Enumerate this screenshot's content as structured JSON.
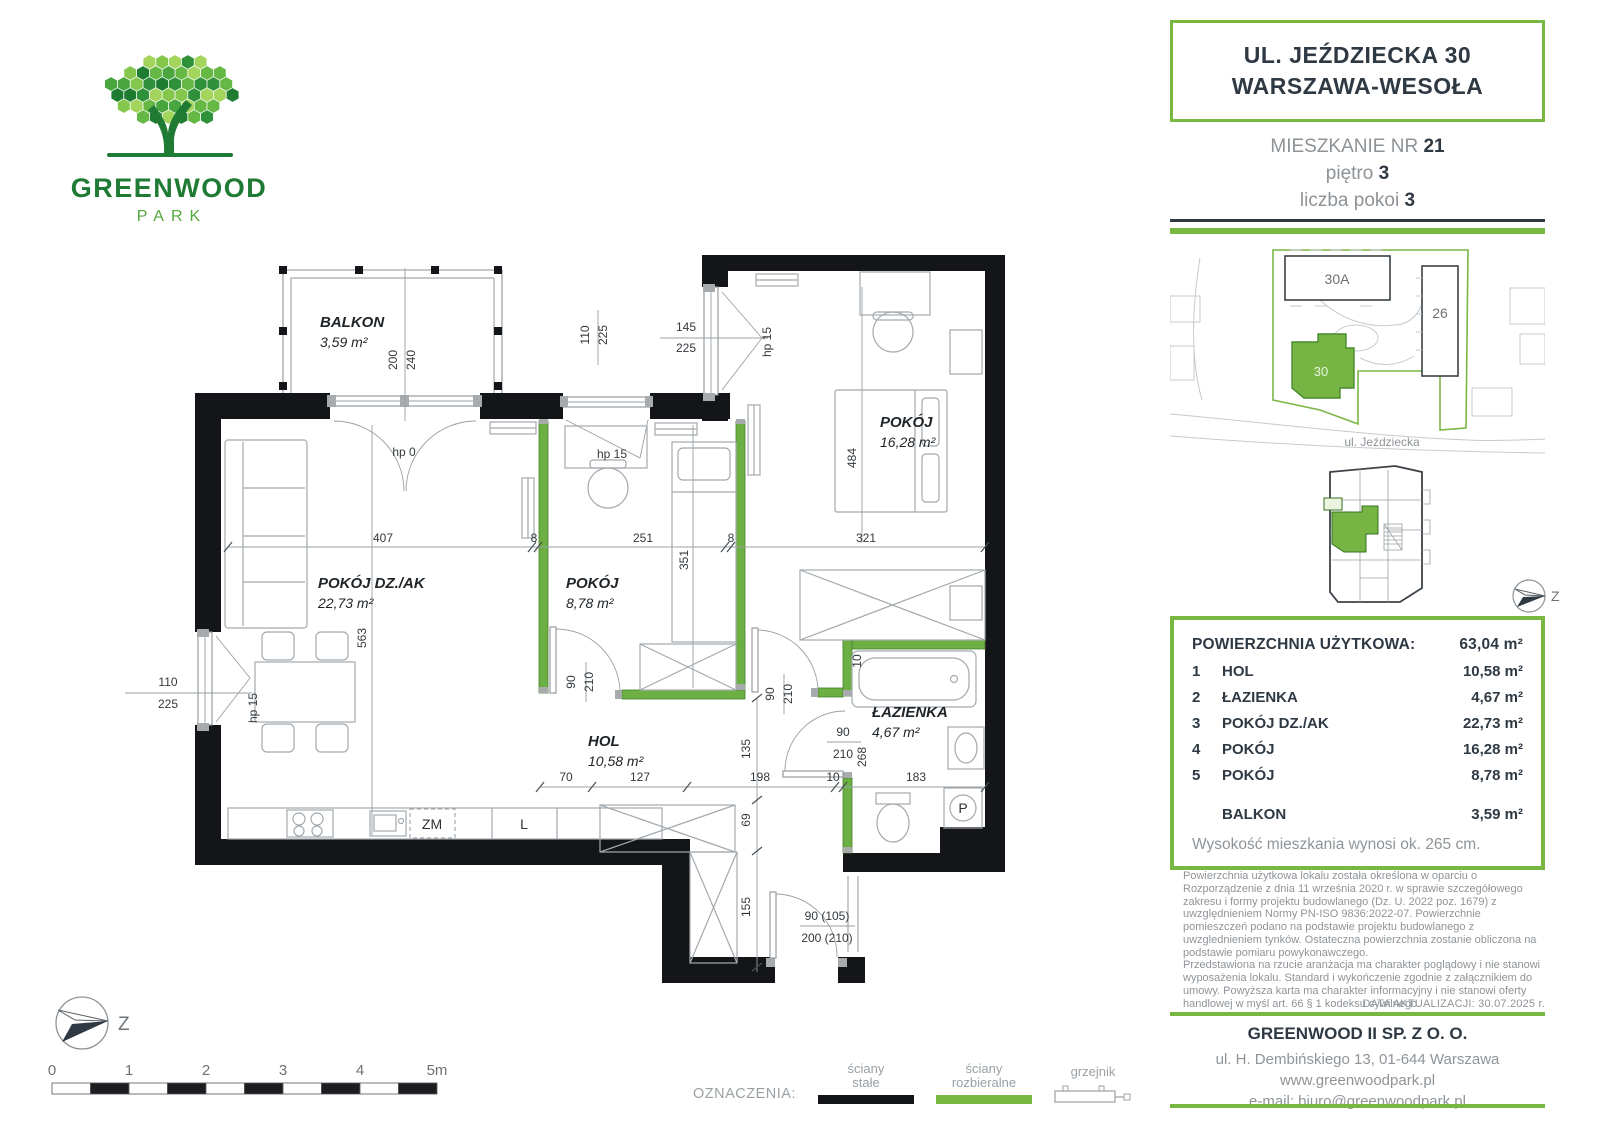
{
  "logo": {
    "title": "GREENWOOD",
    "subtitle": "PARK"
  },
  "header": {
    "address_line1": "UL. JEŹDZIECKA 30",
    "address_line2": "WARSZAWA-WESOŁA",
    "unit_label": "MIESZKANIE NR",
    "unit_number": "21",
    "floor_label": "piętro",
    "floor_value": "3",
    "rooms_label": "liczba pokoi",
    "rooms_value": "3"
  },
  "site_plan": {
    "building_a": "30A",
    "building_b": "26",
    "building_current": "30",
    "street": "ul. Jeździecka"
  },
  "compass": {
    "label": "Z"
  },
  "areas_panel": {
    "title": "POWIERZCHNIA UŻYTKOWA:",
    "total": "63,04 m²",
    "rows": [
      {
        "no": "1",
        "name": "HOL",
        "area": "10,58 m²"
      },
      {
        "no": "2",
        "name": "ŁAZIENKA",
        "area": "4,67 m²"
      },
      {
        "no": "3",
        "name": "POKÓJ DZ./AK",
        "area": "22,73 m²"
      },
      {
        "no": "4",
        "name": "POKÓJ",
        "area": "16,28 m²"
      },
      {
        "no": "5",
        "name": "POKÓJ",
        "area": "8,78 m²"
      }
    ],
    "balcony_row": {
      "no": "",
      "name": "BALKON",
      "area": "3,59 m²"
    },
    "height_note": "Wysokość mieszkania wynosi ok. 265 cm."
  },
  "disclaimer": {
    "p1": "Powierzchnia użytkowa lokalu została określona w oparciu o Rozporządzenie z dnia 11 września 2020 r. w sprawie szczegółowego zakresu i formy projektu budowlanego (Dz. U. 2022 poz. 1679) z uwzględnieniem Normy PN-ISO 9836:2022-07. Powierzchnie pomieszczeń podano na podstawie projektu budowlanego z uwzglednieniem tynków. Ostateczna powierzchnia zostanie obliczona na podstawie pomiaru powykonawczego.",
    "p2": "Przedstawiona na rzucie aranżacja ma charakter poglądowy i nie stanowi wyposażenia lokalu. Standard i wykończenie zgodnie z załącznikiem do umowy. Powyższa karta ma charakter informacyjny i nie stanowi oferty handlowej w myśl art. 66 § 1 kodeksu cywilnego.",
    "updated": "DATA AKTUALIZACJI: 30.07.2025 r."
  },
  "footer": {
    "company": "GREENWOOD II SP. Z O. O.",
    "address": "ul. H. Dembińskiego 13, 01-644 Warszawa",
    "website": "www.greenwoodpark.pl",
    "email": "e-mail: biuro@greenwoodpark.pl"
  },
  "legend": {
    "label": "OZNACZENIA:",
    "wall_solid_l1": "ściany",
    "wall_solid_l2": "stałe",
    "wall_removable_l1": "ściany",
    "wall_removable_l2": "rozbieralne",
    "radiator": "grzejnik"
  },
  "scale_bar": {
    "ticks": [
      "0",
      "1",
      "2",
      "3",
      "4",
      "5m"
    ]
  },
  "plan": {
    "rooms": [
      {
        "name": "BALKON",
        "area": "3,59 m²",
        "x": 320,
        "y": 97
      },
      {
        "name": "POKÓJ DZ./AK",
        "area": "22,73 m²",
        "x": 318,
        "y": 358
      },
      {
        "name": "POKÓJ",
        "area": "8,78 m²",
        "x": 566,
        "y": 358
      },
      {
        "name": "POKÓJ",
        "area": "16,28 m²",
        "x": 880,
        "y": 197
      },
      {
        "name": "HOL",
        "area": "10,58 m²",
        "x": 588,
        "y": 516
      },
      {
        "name": "ŁAZIENKA",
        "area": "4,67 m²",
        "x": 872,
        "y": 487
      }
    ],
    "dims": [
      {
        "t": "200",
        "x": 397,
        "y": 130,
        "r": 1
      },
      {
        "t": "240",
        "x": 415,
        "y": 130,
        "r": 1
      },
      {
        "t": "110",
        "x": 589,
        "y": 105,
        "r": 1
      },
      {
        "t": "225",
        "x": 607,
        "y": 105,
        "r": 1
      },
      {
        "t": "145",
        "x": 686,
        "y": 101
      },
      {
        "t": "225",
        "x": 686,
        "y": 122
      },
      {
        "t": "hp 15",
        "x": 771,
        "y": 112,
        "r": 1
      },
      {
        "t": "hp 0",
        "x": 404,
        "y": 226
      },
      {
        "t": "hp 15",
        "x": 612,
        "y": 228
      },
      {
        "t": "110",
        "x": 168,
        "y": 456
      },
      {
        "t": "225",
        "x": 168,
        "y": 478
      },
      {
        "t": "hp 15",
        "x": 257,
        "y": 478,
        "r": 1
      },
      {
        "t": "407",
        "x": 383,
        "y": 312
      },
      {
        "t": "8",
        "x": 534,
        "y": 312
      },
      {
        "t": "251",
        "x": 643,
        "y": 312
      },
      {
        "t": "8",
        "x": 731,
        "y": 312
      },
      {
        "t": "321",
        "x": 866,
        "y": 312
      },
      {
        "t": "351",
        "x": 688,
        "y": 330,
        "r": 1
      },
      {
        "t": "563",
        "x": 366,
        "y": 408,
        "r": 1
      },
      {
        "t": "484",
        "x": 856,
        "y": 228,
        "r": 1
      },
      {
        "t": "90",
        "x": 575,
        "y": 452,
        "r": 1
      },
      {
        "t": "210",
        "x": 593,
        "y": 452,
        "r": 1
      },
      {
        "t": "90",
        "x": 774,
        "y": 464,
        "r": 1
      },
      {
        "t": "210",
        "x": 792,
        "y": 464,
        "r": 1
      },
      {
        "t": "10",
        "x": 861,
        "y": 431,
        "r": 1
      },
      {
        "t": "90",
        "x": 843,
        "y": 506
      },
      {
        "t": "210",
        "x": 843,
        "y": 528
      },
      {
        "t": "268",
        "x": 866,
        "y": 527,
        "r": 1
      },
      {
        "t": "70",
        "x": 566,
        "y": 551
      },
      {
        "t": "127",
        "x": 640,
        "y": 551
      },
      {
        "t": "198",
        "x": 760,
        "y": 551
      },
      {
        "t": "10",
        "x": 833,
        "y": 551
      },
      {
        "t": "183",
        "x": 916,
        "y": 551
      },
      {
        "t": "135",
        "x": 750,
        "y": 519,
        "r": 1
      },
      {
        "t": "69",
        "x": 750,
        "y": 590,
        "r": 1
      },
      {
        "t": "155",
        "x": 750,
        "y": 677,
        "r": 1
      },
      {
        "t": "90 (105)",
        "x": 827,
        "y": 690
      },
      {
        "t": "200 (210)",
        "x": 827,
        "y": 712
      }
    ],
    "fixtures": {
      "dishwasher": "ZM",
      "fridge": "L",
      "washer": "P"
    }
  }
}
